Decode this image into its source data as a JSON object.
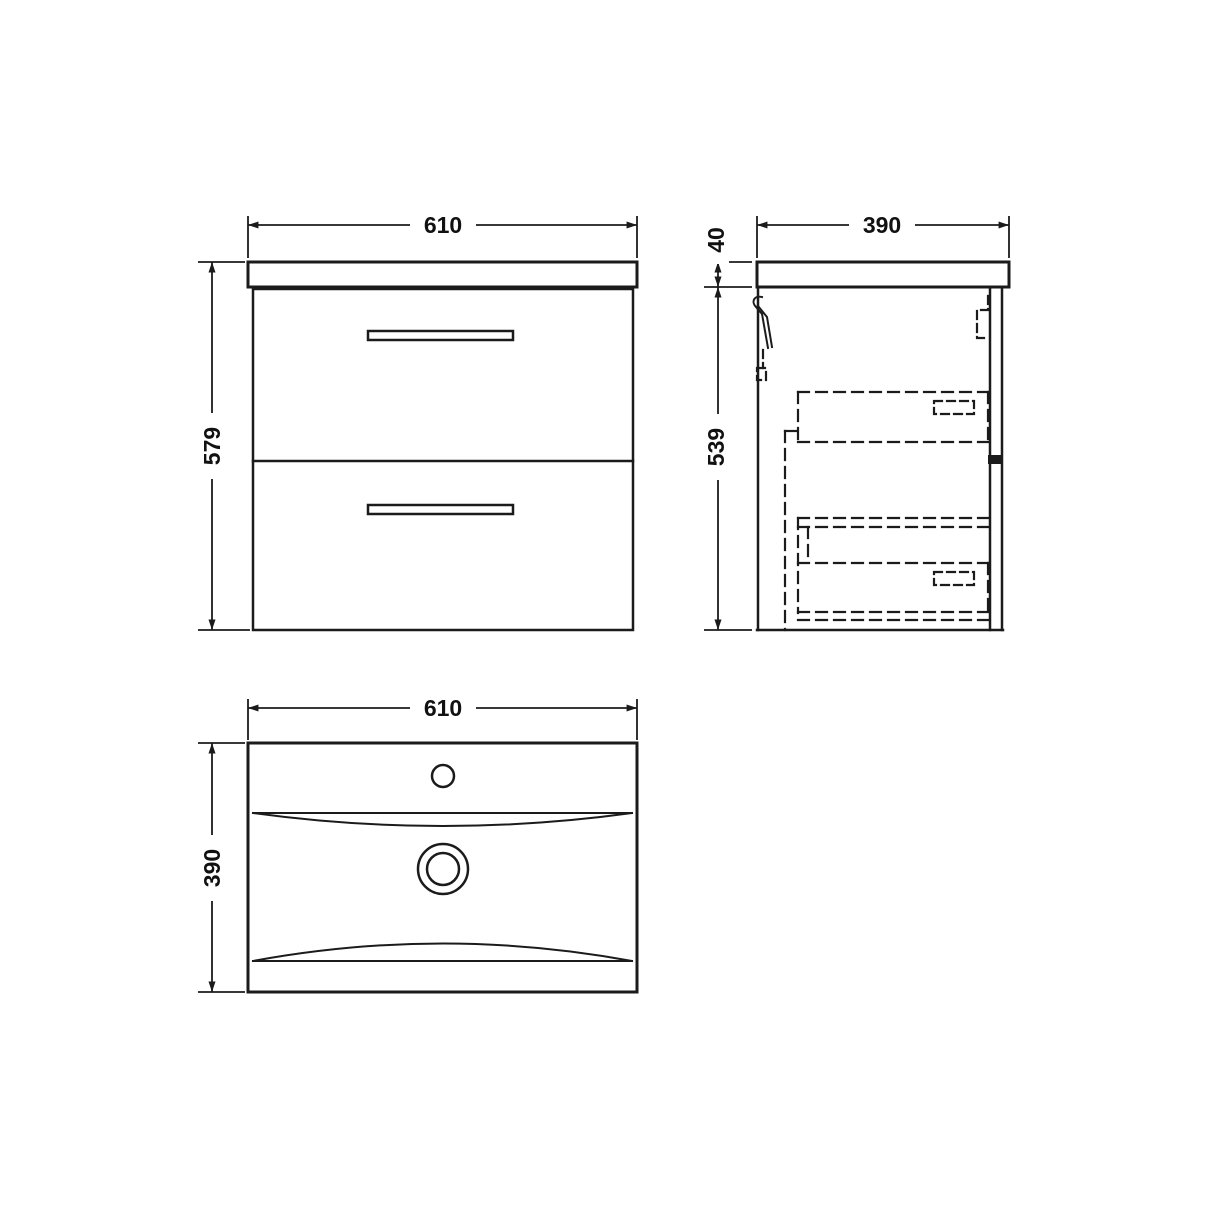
{
  "page": {
    "background": "#ffffff",
    "ink": "#1b1b1b",
    "description_labels_only": "technical drawing of wall-hung vanity unit"
  },
  "views": {
    "front": {
      "width": "610",
      "height": "579"
    },
    "side": {
      "depth": "390",
      "worktop_thickness": "40",
      "cabinet_height": "539"
    },
    "plan": {
      "width": "610",
      "depth": "390"
    }
  }
}
